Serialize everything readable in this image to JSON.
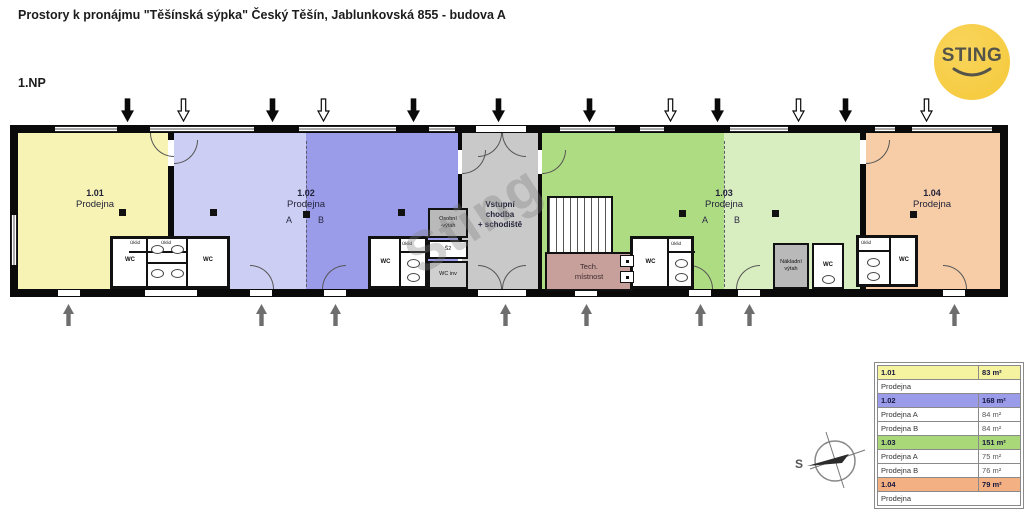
{
  "header": {
    "title": "Prostory k pronájmu \"Těšínská sýpka\" Český Těšín, Jablunkovská 855 - budova A"
  },
  "floor_label": "1.NP",
  "logo": {
    "text": "STING"
  },
  "watermark": "Sting",
  "rooms": {
    "r101": {
      "number": "1.01",
      "name": "Prodejna"
    },
    "r102": {
      "number": "1.02",
      "name": "Prodejna",
      "a": "A",
      "b": "B"
    },
    "r103": {
      "number": "1.03",
      "name": "Prodejna",
      "a": "A",
      "b": "B"
    },
    "r104": {
      "number": "1.04",
      "name": "Prodejna"
    },
    "corridor": {
      "line1": "Vstupní",
      "line2": "chodba",
      "line3": "+ schodiště"
    },
    "tech": {
      "line1": "Tech.",
      "line2": "místnost"
    },
    "passenger_lift": {
      "line1": "Osobní",
      "line2": "-výtah"
    },
    "freight_lift": {
      "line1": "Nákladní",
      "line2": "výtah"
    },
    "s2": "Š2",
    "wc_inv": "WC inv",
    "wc": "WC",
    "uklid": "Úklid"
  },
  "compass": {
    "label": "S"
  },
  "colors": {
    "room_101": "#f6f3b4",
    "room_102_a": "#cdcef3",
    "room_102_b": "#9a9ce9",
    "corridor": "#c9c9c9",
    "room_103_a": "#aedc82",
    "room_103_b": "#d9eec0",
    "room_104": "#f6cda6",
    "tech_room": "#c7a09c",
    "lift": "#b9b9b9",
    "wc_inv_room": "#cfcfcf",
    "wall": "#0a0a0a",
    "logo_bg": "#f5c838",
    "logo_fg": "#55544a",
    "table_101": "#f6f3a0",
    "table_102": "#9a9ce9",
    "table_103": "#a9d878",
    "table_104": "#f3b183"
  },
  "arrows": {
    "top": [
      {
        "x": 127,
        "style": "filled"
      },
      {
        "x": 183,
        "style": "outline"
      },
      {
        "x": 272,
        "style": "filled"
      },
      {
        "x": 323,
        "style": "outline"
      },
      {
        "x": 413,
        "style": "filled"
      },
      {
        "x": 498,
        "style": "filled"
      },
      {
        "x": 589,
        "style": "filled"
      },
      {
        "x": 670,
        "style": "outline"
      },
      {
        "x": 717,
        "style": "filled"
      },
      {
        "x": 798,
        "style": "outline"
      },
      {
        "x": 845,
        "style": "filled"
      },
      {
        "x": 926,
        "style": "outline"
      }
    ],
    "bottom": [
      {
        "x": 68
      },
      {
        "x": 261
      },
      {
        "x": 335
      },
      {
        "x": 505
      },
      {
        "x": 586
      },
      {
        "x": 700
      },
      {
        "x": 749
      },
      {
        "x": 954
      }
    ]
  },
  "legend_table": {
    "rows": [
      {
        "label": "1.01",
        "value": "83 m²",
        "variant": "r101",
        "span": false
      },
      {
        "label": "Prodejna",
        "value": "",
        "variant": "plain",
        "span": true
      },
      {
        "label": "1.02",
        "value": "168 m²",
        "variant": "r102",
        "span": false
      },
      {
        "label": "Prodejna A",
        "value": "84 m²",
        "variant": "plain",
        "span": false
      },
      {
        "label": "Prodejna B",
        "value": "84 m²",
        "variant": "plain",
        "span": false
      },
      {
        "label": "1.03",
        "value": "151 m²",
        "variant": "r103",
        "span": false
      },
      {
        "label": "Prodejna A",
        "value": "75 m²",
        "variant": "plain",
        "span": false
      },
      {
        "label": "Prodejna B",
        "value": "76 m²",
        "variant": "plain",
        "span": false
      },
      {
        "label": "1.04",
        "value": "79 m²",
        "variant": "r104",
        "span": false
      },
      {
        "label": "Prodejna",
        "value": "",
        "variant": "plain",
        "span": true
      }
    ]
  }
}
